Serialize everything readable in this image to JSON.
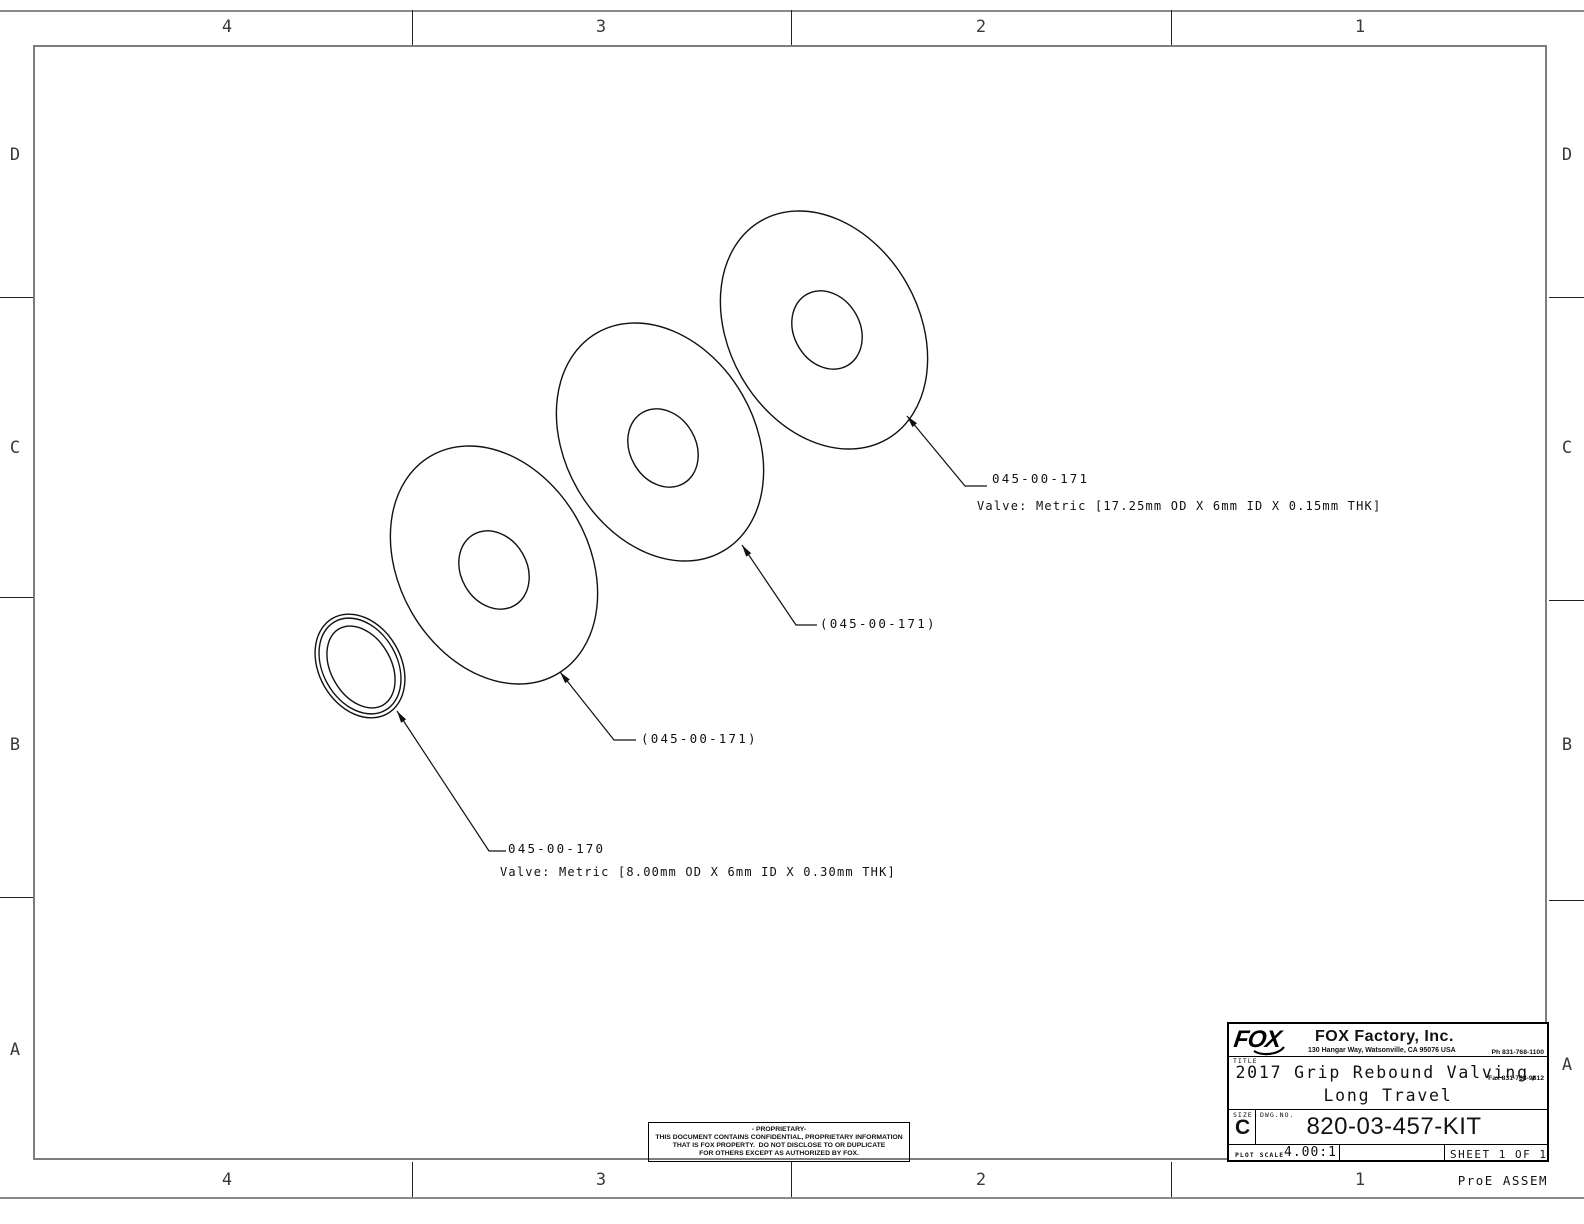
{
  "zones": {
    "columns": [
      "4",
      "3",
      "2",
      "1"
    ],
    "rows": [
      "D",
      "C",
      "B",
      "A"
    ]
  },
  "callouts": {
    "c1": {
      "part": "045-00-171",
      "desc": "Valve: Metric [17.25mm OD X 6mm ID X 0.15mm THK]"
    },
    "c2": {
      "part": "(045-00-171)"
    },
    "c3": {
      "part": "(045-00-171)"
    },
    "c4": {
      "part": "045-00-170",
      "desc": "Valve: Metric [8.00mm OD X 6mm ID X 0.30mm THK]"
    }
  },
  "proprietary": {
    "lines": [
      "- PROPRIETARY-",
      "THIS DOCUMENT CONTAINS CONFIDENTIAL, PROPRIETARY INFORMATION",
      "THAT IS FOX PROPERTY.  DO NOT DISCLOSE TO OR DUPLICATE",
      "FOR OTHERS EXCEPT AS AUTHORIZED BY FOX."
    ]
  },
  "title_block": {
    "logo": "FOX",
    "company": "FOX Factory, Inc.",
    "address": "130 Hangar Way, Watsonville, CA 95076 USA",
    "phone": "Ph 831-768-1100",
    "fax": "Fax 831-768-9312",
    "title_label": "TITLE",
    "title_line1": "2017 Grip Rebound Valving,",
    "title_line2": "Long Travel",
    "size_label": "SIZE",
    "size": "C",
    "dwg_label": "DWG.NO.",
    "dwg_no": "820-03-457-KIT",
    "plot_scale_label": "PLOT SCALE",
    "plot_scale": "4.00:1",
    "sheet": "SHEET 1 OF 1"
  },
  "footer": {
    "app": "ProE ASSEM"
  },
  "colors": {
    "drawing_line": "#111111",
    "frame_gray": "#7d7d7d",
    "title_block_line": "#000000"
  }
}
